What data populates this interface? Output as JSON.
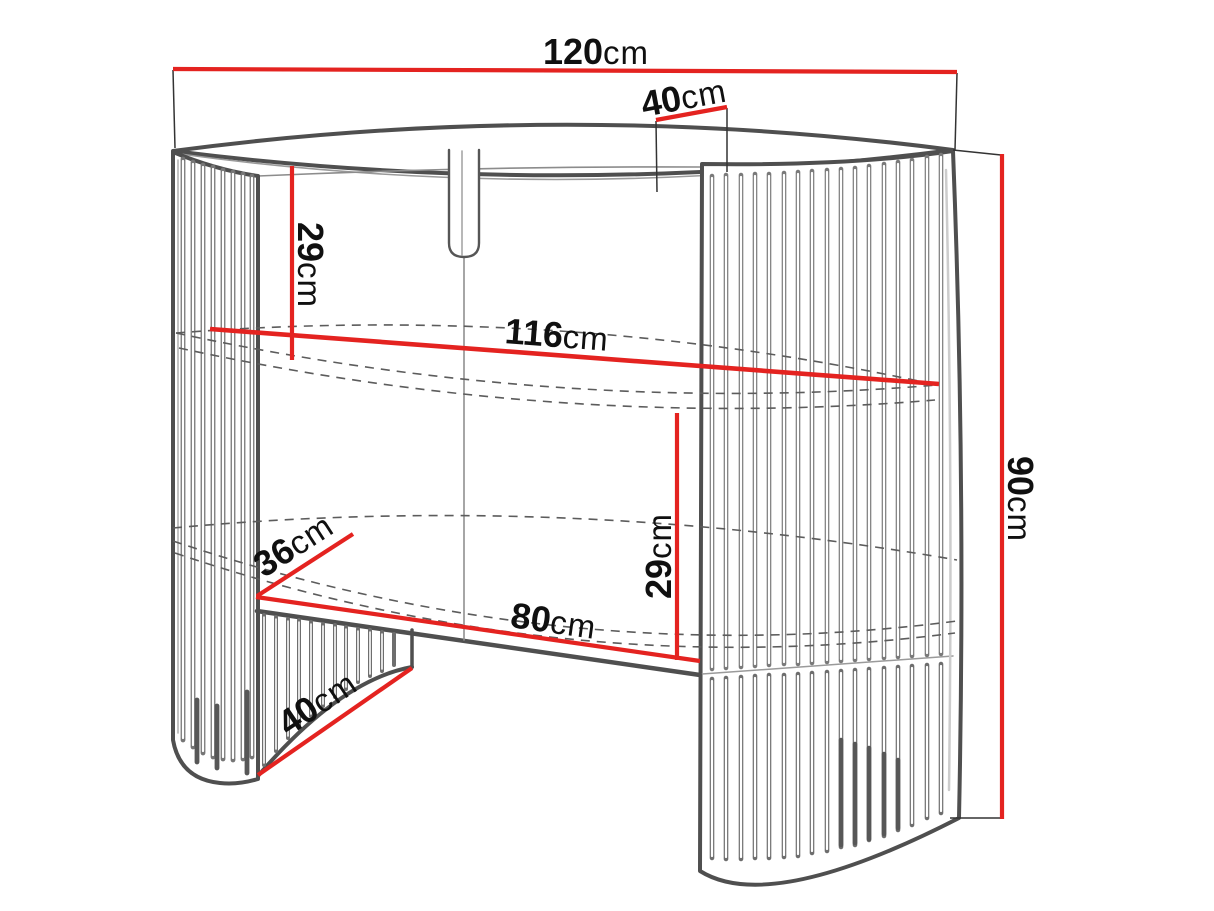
{
  "diagram": {
    "title": "furniture-dimension-diagram",
    "unit": "cm",
    "colors": {
      "dimension_line": "#e42320",
      "outline_dark": "#4f4f4f",
      "outline_light": "#8c8c8c",
      "slat": "#767676",
      "slat_dark": "#575757",
      "dashed_hidden_edge": "#5c5c5c",
      "text": "#101010",
      "background": "#ffffff"
    },
    "dimensions": {
      "width_total": {
        "value": "120",
        "unit": "cm"
      },
      "depth_top": {
        "value": "40",
        "unit": "cm"
      },
      "height_top_section": {
        "value": "29",
        "unit": "cm"
      },
      "width_inner": {
        "value": "116",
        "unit": "cm"
      },
      "height_total": {
        "value": "90",
        "unit": "cm"
      },
      "height_shelf_section": {
        "value": "29",
        "unit": "cm"
      },
      "depth_side": {
        "value": "36",
        "unit": "cm"
      },
      "width_opening": {
        "value": "80",
        "unit": "cm"
      },
      "depth_base": {
        "value": "40",
        "unit": "cm"
      }
    }
  }
}
